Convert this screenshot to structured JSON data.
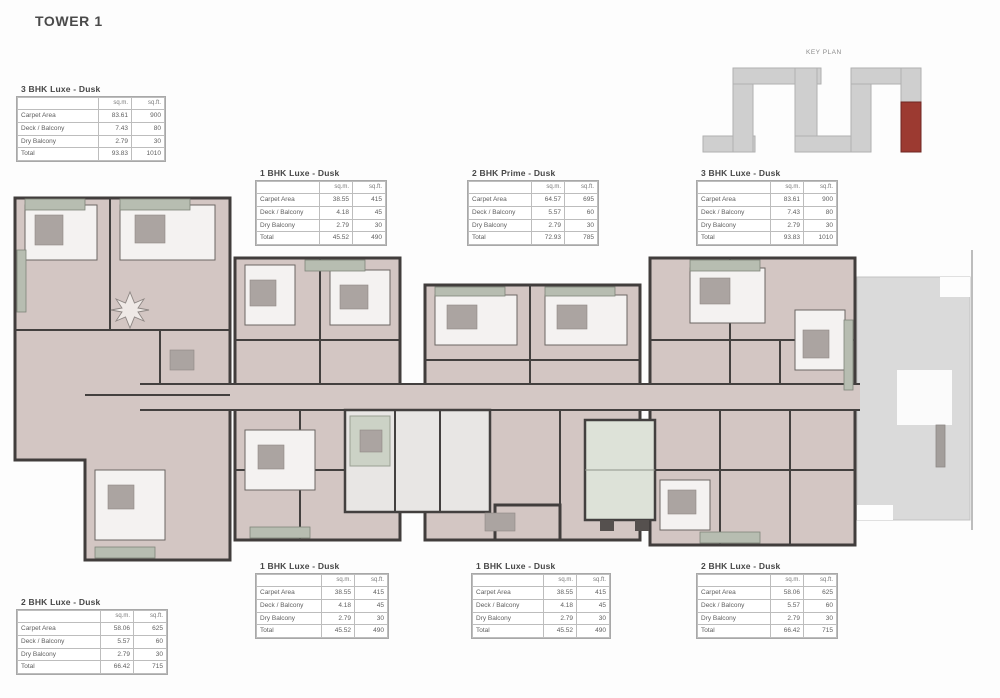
{
  "page": {
    "title": "TOWER 1"
  },
  "keyplan": {
    "label": "KEY PLAN",
    "body_color": "#cfcfcf",
    "highlight_color": "#9c3a31"
  },
  "floor_plan": {
    "floor_color": "#d3c6c3",
    "wall_color": "#413d3c",
    "glazing_color": "#b7bdb1",
    "terrace_color": "#dadada",
    "furniture_color": "#aba4a1"
  },
  "unit_tables": [
    {
      "title": "3 BHK Luxe - Dusk",
      "columns": [
        "",
        "sq.m.",
        "sq.ft."
      ],
      "rows": [
        [
          "Carpet Area",
          "83.61",
          "900"
        ],
        [
          "Deck / Balcony",
          "7.43",
          "80"
        ],
        [
          "Dry Balcony",
          "2.79",
          "30"
        ],
        [
          "Total",
          "93.83",
          "1010"
        ]
      ]
    },
    {
      "title": "1 BHK Luxe - Dusk",
      "columns": [
        "",
        "sq.m.",
        "sq.ft."
      ],
      "rows": [
        [
          "Carpet Area",
          "38.55",
          "415"
        ],
        [
          "Deck / Balcony",
          "4.18",
          "45"
        ],
        [
          "Dry Balcony",
          "2.79",
          "30"
        ],
        [
          "Total",
          "45.52",
          "490"
        ]
      ]
    },
    {
      "title": "2 BHK Prime - Dusk",
      "columns": [
        "",
        "sq.m.",
        "sq.ft."
      ],
      "rows": [
        [
          "Carpet Area",
          "64.57",
          "695"
        ],
        [
          "Deck / Balcony",
          "5.57",
          "60"
        ],
        [
          "Dry Balcony",
          "2.79",
          "30"
        ],
        [
          "Total",
          "72.93",
          "785"
        ]
      ]
    },
    {
      "title": "3 BHK Luxe - Dusk",
      "columns": [
        "",
        "sq.m.",
        "sq.ft."
      ],
      "rows": [
        [
          "Carpet Area",
          "83.61",
          "900"
        ],
        [
          "Deck / Balcony",
          "7.43",
          "80"
        ],
        [
          "Dry Balcony",
          "2.79",
          "30"
        ],
        [
          "Total",
          "93.83",
          "1010"
        ]
      ]
    },
    {
      "title": "1 BHK Luxe - Dusk",
      "columns": [
        "",
        "sq.m.",
        "sq.ft."
      ],
      "rows": [
        [
          "Carpet Area",
          "38.55",
          "415"
        ],
        [
          "Deck / Balcony",
          "4.18",
          "45"
        ],
        [
          "Dry Balcony",
          "2.79",
          "30"
        ],
        [
          "Total",
          "45.52",
          "490"
        ]
      ]
    },
    {
      "title": "1 BHK Luxe - Dusk",
      "columns": [
        "",
        "sq.m.",
        "sq.ft."
      ],
      "rows": [
        [
          "Carpet Area",
          "38.55",
          "415"
        ],
        [
          "Deck / Balcony",
          "4.18",
          "45"
        ],
        [
          "Dry Balcony",
          "2.79",
          "30"
        ],
        [
          "Total",
          "45.52",
          "490"
        ]
      ]
    },
    {
      "title": "2 BHK Luxe - Dusk",
      "columns": [
        "",
        "sq.m.",
        "sq.ft."
      ],
      "rows": [
        [
          "Carpet Area",
          "58.06",
          "625"
        ],
        [
          "Deck / Balcony",
          "5.57",
          "60"
        ],
        [
          "Dry Balcony",
          "2.79",
          "30"
        ],
        [
          "Total",
          "66.42",
          "715"
        ]
      ]
    },
    {
      "title": "2 BHK Luxe - Dusk",
      "columns": [
        "",
        "sq.m.",
        "sq.ft."
      ],
      "rows": [
        [
          "Carpet Area",
          "58.06",
          "625"
        ],
        [
          "Deck / Balcony",
          "5.57",
          "60"
        ],
        [
          "Dry Balcony",
          "2.79",
          "30"
        ],
        [
          "Total",
          "66.42",
          "715"
        ]
      ]
    }
  ]
}
